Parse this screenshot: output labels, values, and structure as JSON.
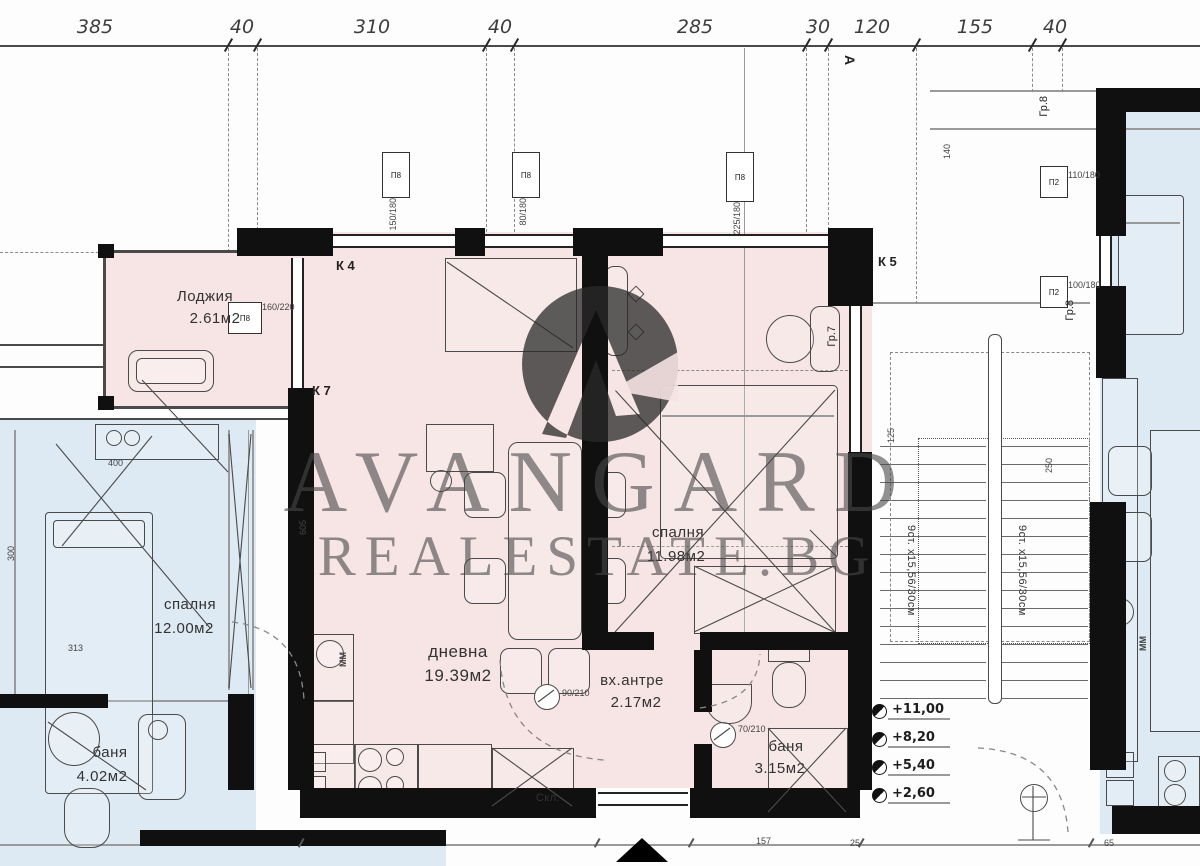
{
  "watermark": {
    "line1": "AVANGARD",
    "line2": "REALESTATE.BG",
    "logo": "avangard-circle-a-logo"
  },
  "top_dimensions": [
    "385",
    "40",
    "310",
    "40",
    "285",
    "30",
    "120",
    "155",
    "40"
  ],
  "axis_labels": {
    "a": "А",
    "k4": "К 4",
    "k5": "К 5",
    "k7": "К 7",
    "gr7": "Гр.7",
    "gr8_a": "Гр.8",
    "gr8_b": "Гр.8"
  },
  "rooms": {
    "loggia": {
      "name": "Лоджия",
      "area": "2.61м2"
    },
    "living": {
      "name": "дневна",
      "area": "19.39м2"
    },
    "bedroom_right": {
      "name": "спалня",
      "area": "11.98м2"
    },
    "entry": {
      "name": "вх.антре",
      "area": "2.17м2"
    },
    "bath_right": {
      "name": "баня",
      "area": "3.15м2"
    },
    "bedroom_left": {
      "name": "спалня",
      "area": "12.00м2"
    },
    "bath_left": {
      "name": "баня",
      "area": "4.02м2"
    },
    "storage_label": "Скл."
  },
  "stairs": {
    "flight_text_left": "9ст. х15,56/30см",
    "flight_text_right": "9ст. х15,56/30см"
  },
  "levels": [
    "+11,00",
    "+8,20",
    "+5,40",
    "+2,60"
  ],
  "window_tags": {
    "loggia_code": "П8",
    "loggia_size": "160/220",
    "top1_code": "П8",
    "top1_size": "150/180",
    "top2_code": "П8",
    "top2_size": "80/180",
    "top3_code": "П8",
    "top3_size": "225/180",
    "right1_code": "П2",
    "right1_size": "110/180",
    "right2_code": "П2",
    "right2_size": "100/180"
  },
  "door_tags": [
    "90/210",
    "70/210"
  ],
  "appliances": {
    "washer_left": "ММ",
    "washer_right": "ММ"
  },
  "misc_dimensions": [
    "400",
    "300",
    "313",
    "605",
    "140",
    "125",
    "250",
    "157",
    "25",
    "65"
  ],
  "colors": {
    "unit_fill": "#f7e4e4",
    "neighbor_fill": "#dde9f3",
    "wall": "#101010",
    "watermark_text": "#5a5a5a"
  }
}
